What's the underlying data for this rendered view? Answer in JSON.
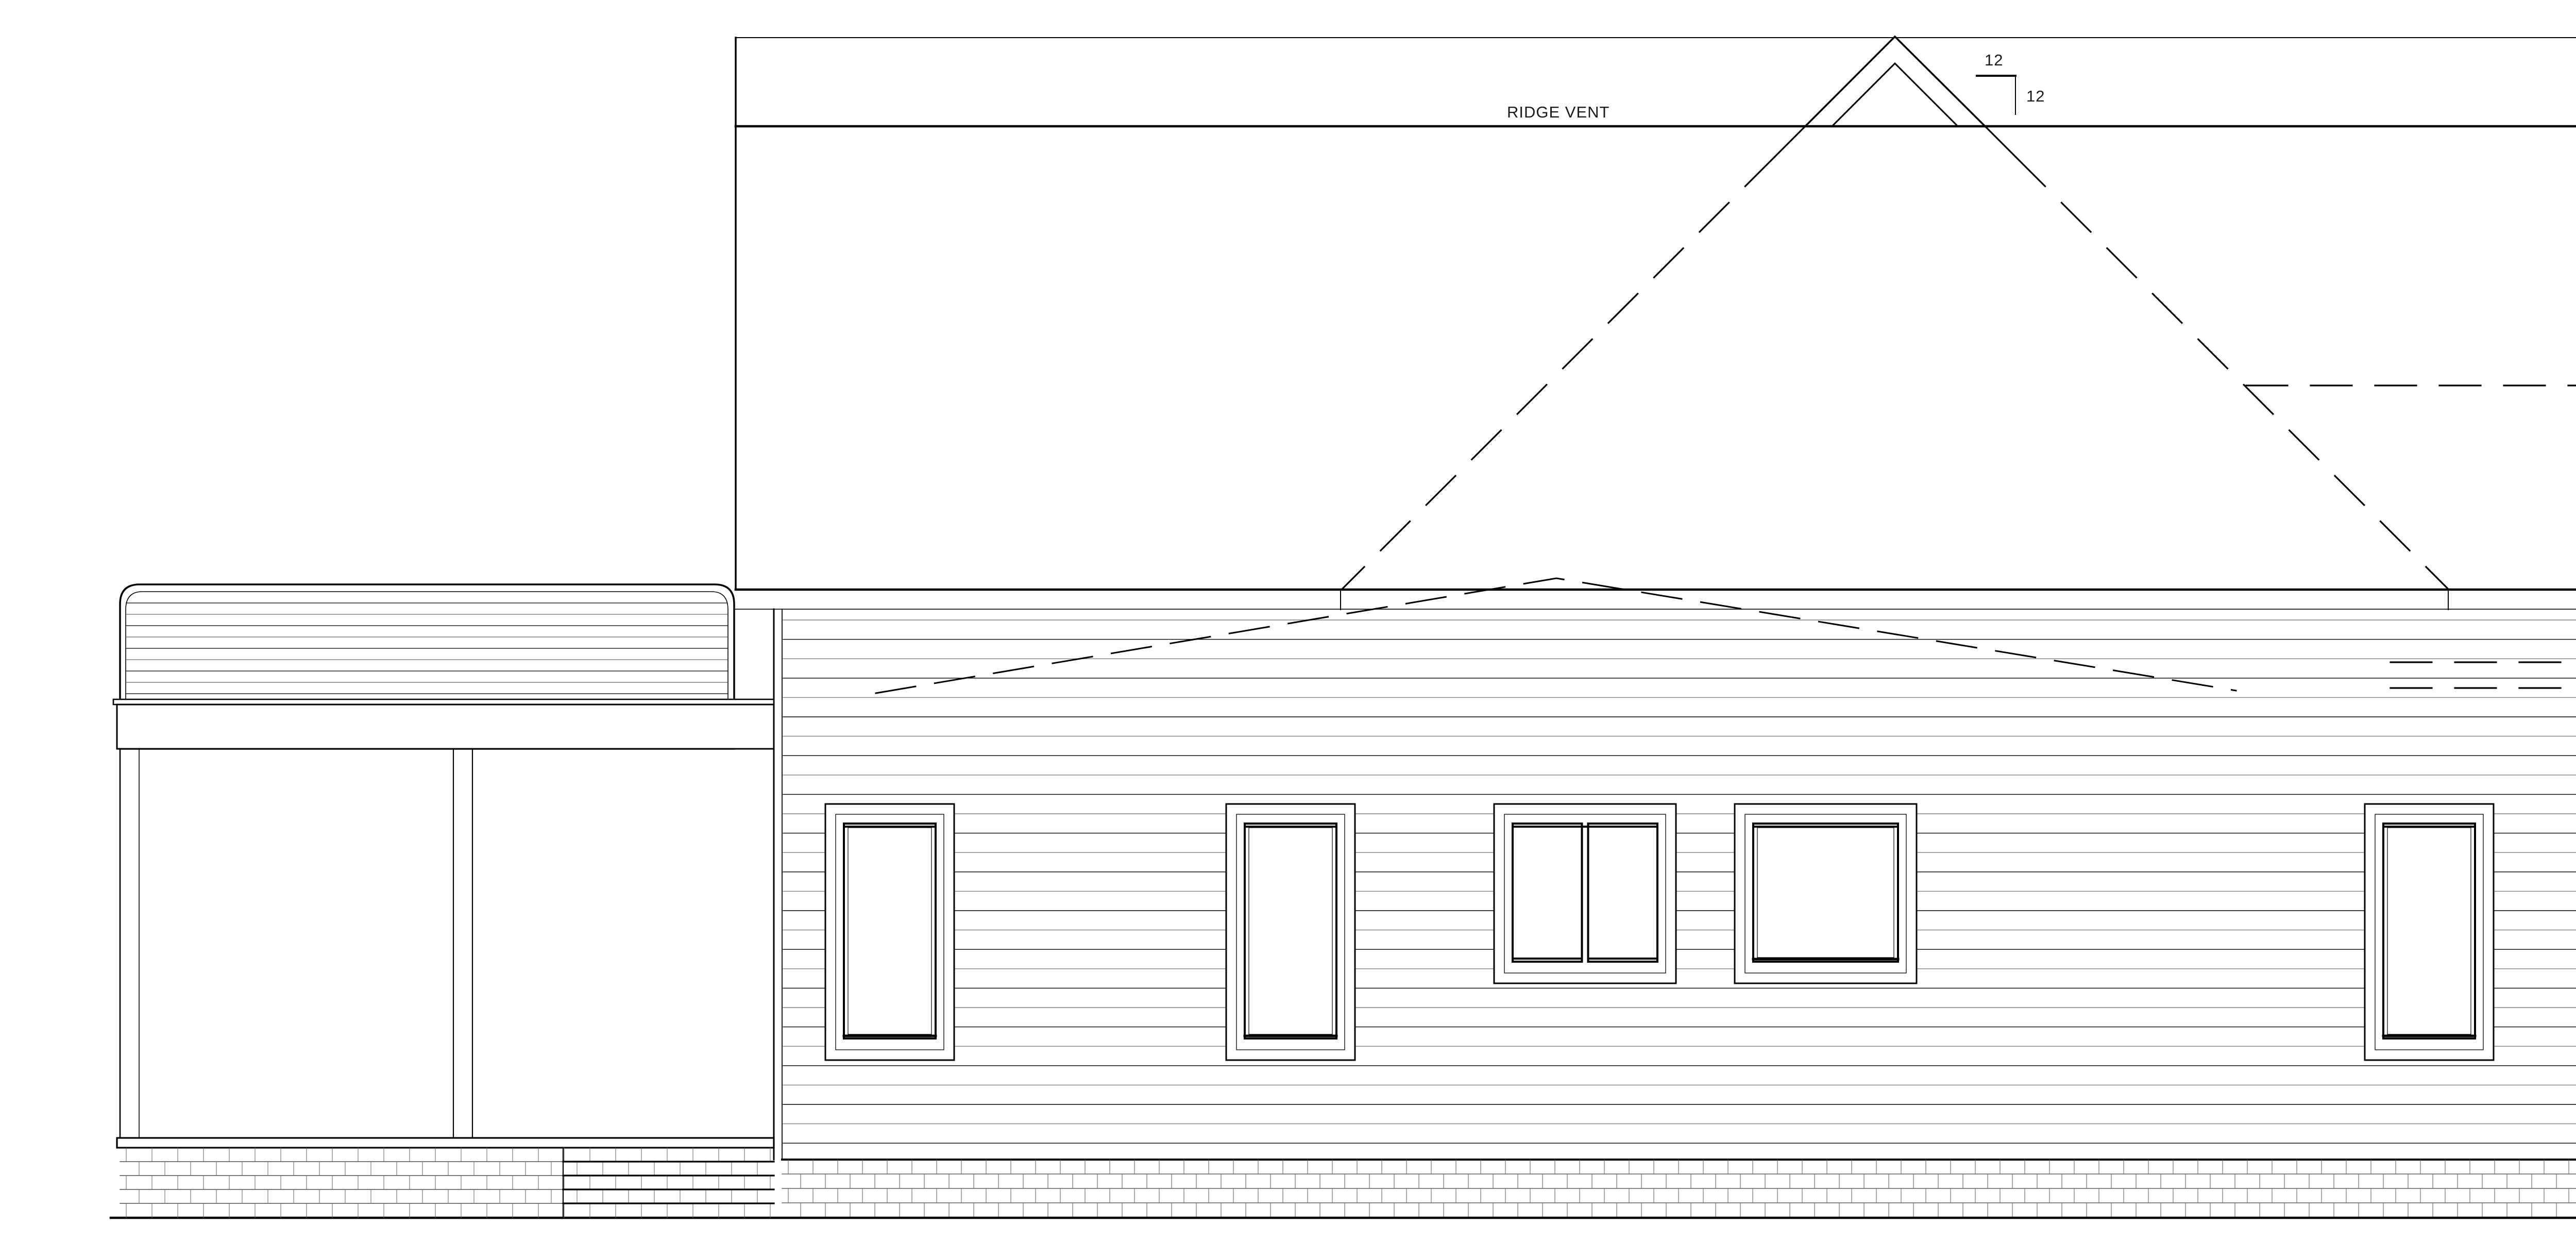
{
  "drawing": {
    "type": "architectural-elevation",
    "labels": {
      "ridge_vent": "RIDGE VENT",
      "pitch_rise": "12",
      "pitch_run": "12"
    },
    "colors": {
      "line": "#000000",
      "siding_alt": "#808080",
      "masonry_joint": "#606060",
      "ground_extension": "#888888",
      "background": "#ffffff"
    }
  }
}
